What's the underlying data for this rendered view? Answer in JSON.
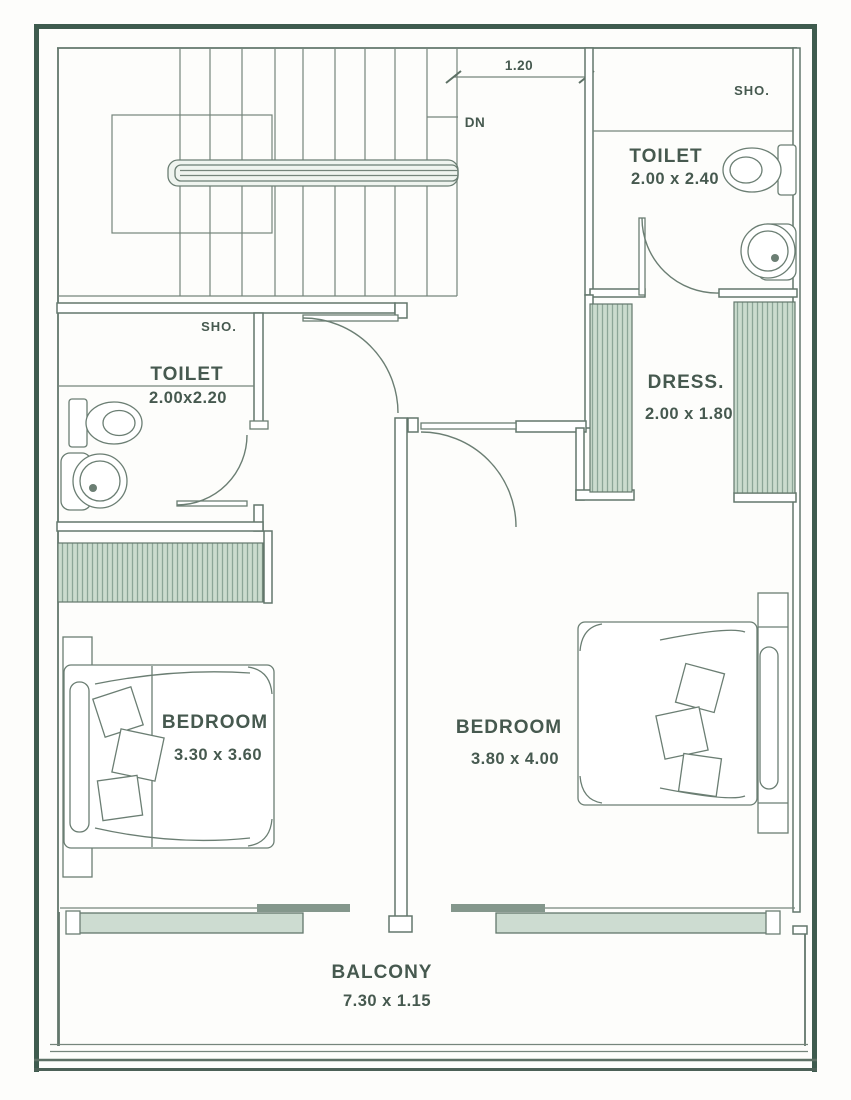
{
  "plan": {
    "staircase": {
      "down_label": "DN",
      "landing_dim": "1.20"
    },
    "toilet_top": {
      "shower_label": "SHO.",
      "name": "TOILET",
      "dim": "2.00 x 2.40"
    },
    "toilet_left": {
      "shower_label": "SHO.",
      "name": "TOILET",
      "dim": "2.00x2.20"
    },
    "dressing": {
      "name": "DRESS.",
      "dim": "2.00 x 1.80"
    },
    "bedroom_left": {
      "name": "BEDROOM",
      "dim": "3.30 x 3.60"
    },
    "bedroom_right": {
      "name": "BEDROOM",
      "dim": "3.80 x 4.00"
    },
    "balcony": {
      "name": "BALCONY",
      "dim": "7.30 x 1.15"
    }
  },
  "colors": {
    "outer_border": "#3e5b4e",
    "wall_line": "#63776c",
    "text": "#46594f",
    "wardrobe_fill": "#cbdccf",
    "wardrobe_stripe": "#8ca698",
    "sliding_panel": "#cddcd1",
    "sliding_track_dark": "#84978c",
    "background": "#fdfdfb"
  }
}
